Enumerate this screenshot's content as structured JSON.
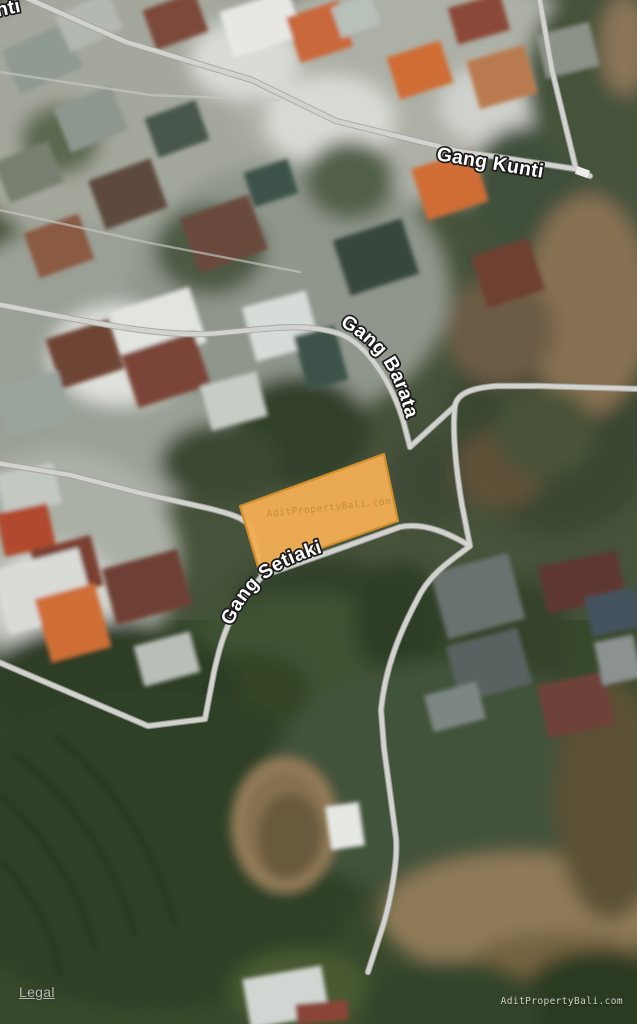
{
  "streets": {
    "gang_kunti": "Gang Kunti",
    "gang_barata": "Gang Barata",
    "gang_setiaki": "Gang Setiaki",
    "corner_fragment": "nti"
  },
  "parcel": {
    "watermark": "AditPropertyBali.com",
    "fill_color": "#f0ad53",
    "border_color": "#cf8f2e"
  },
  "roads": {
    "color": "#d2d3cf",
    "casing_color": "#a3a49f"
  },
  "footer": {
    "legal_label": "Legal",
    "watermark": "AditPropertyBali.com"
  }
}
